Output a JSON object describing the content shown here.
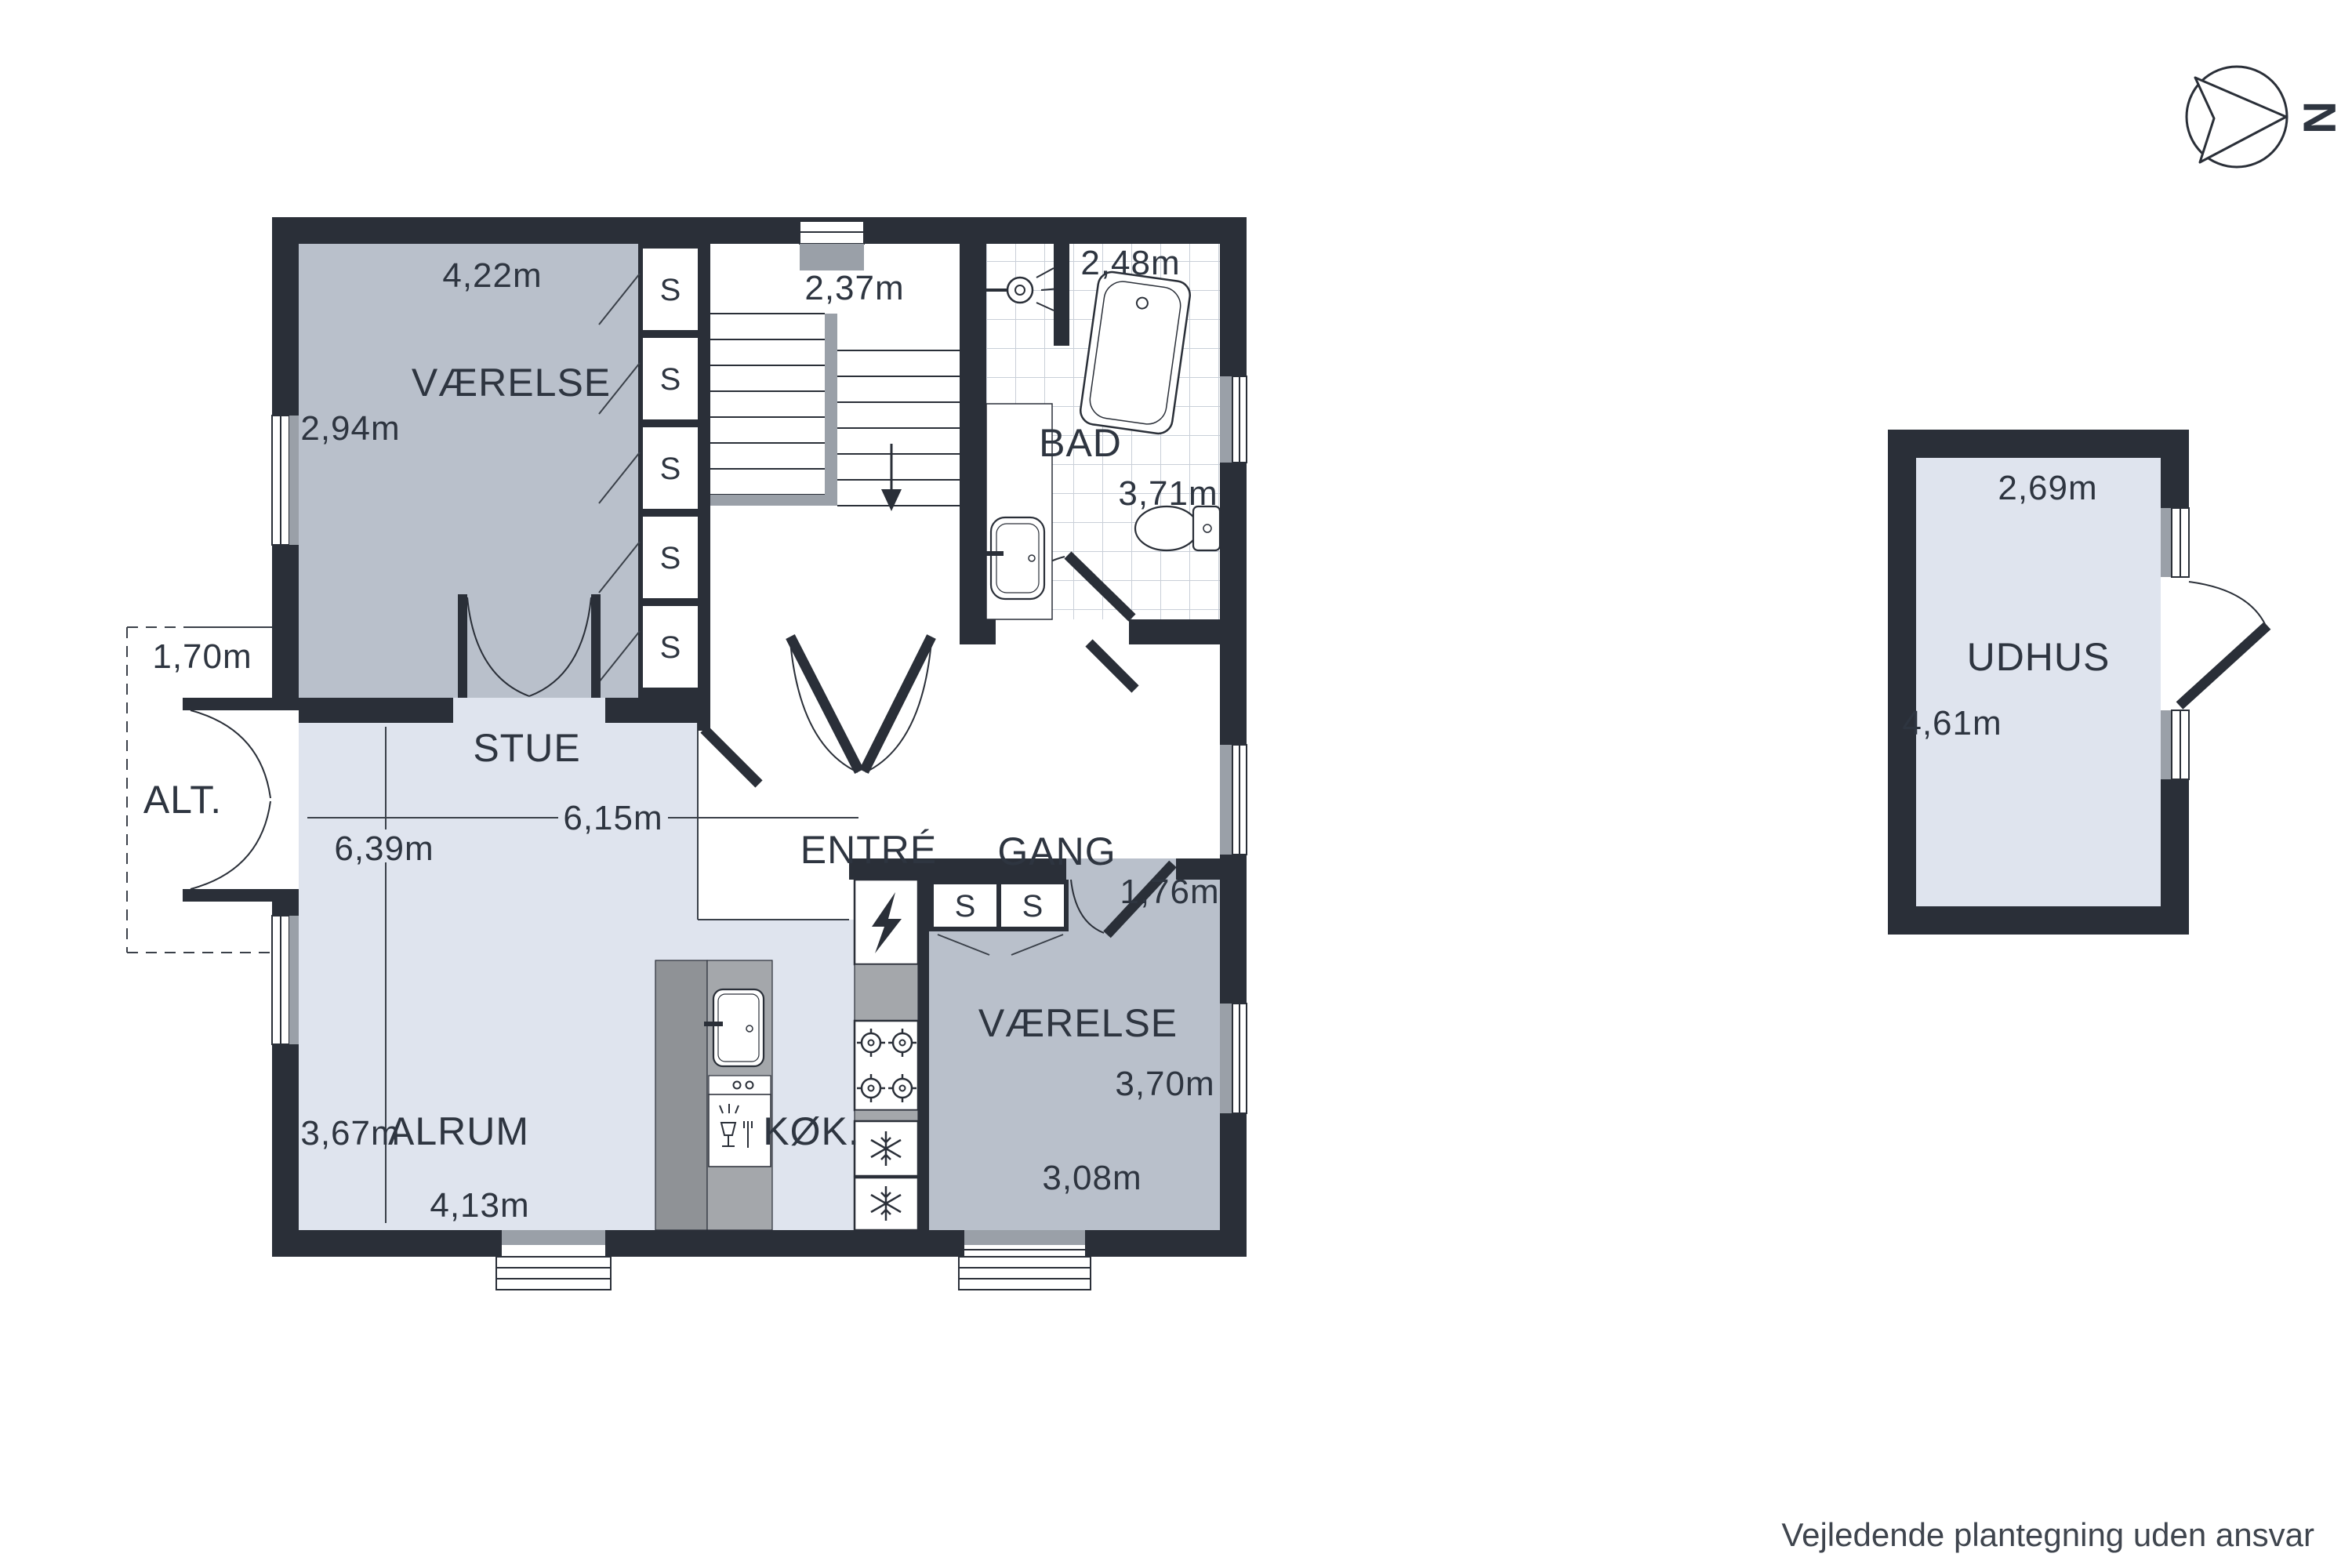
{
  "plan": {
    "disclaimer": "Vejledende plantegning uden ansvar",
    "compass_north": "N",
    "closet_letter": "S",
    "rooms": {
      "vaerelse_tl": {
        "label": "VÆRELSE",
        "dim_top": "4,22m",
        "dim_left": "2,94m"
      },
      "trappe": {
        "dim_top": "2,37m"
      },
      "bad": {
        "label": "BAD",
        "dim_top": "2,48m",
        "dim_right": "3,71m"
      },
      "stue": {
        "label": "STUE",
        "dim_width": "6,15m",
        "dim_height": "6,39m"
      },
      "entre": {
        "label": "ENTRÉ"
      },
      "gang": {
        "label": "GANG",
        "dim": "1,76m"
      },
      "alt": {
        "label": "ALT.",
        "dim": "1,70m"
      },
      "alrum": {
        "label": "ALRUM",
        "dim_left": "3,67m",
        "dim_bottom": "4,13m"
      },
      "koekken": {
        "label": "KØK."
      },
      "vaerelse_br": {
        "label": "VÆRELSE",
        "dim_right": "3,70m",
        "dim_bottom": "3,08m"
      },
      "udhus": {
        "label": "UDHUS",
        "dim_top": "2,69m",
        "dim_left": "4,61m"
      }
    },
    "colors": {
      "wall": "#2a2f38",
      "floor_light": "#dfe4ee",
      "floor_gray": "#b9c0cb",
      "accent_gray": "#9aa0a8"
    }
  }
}
